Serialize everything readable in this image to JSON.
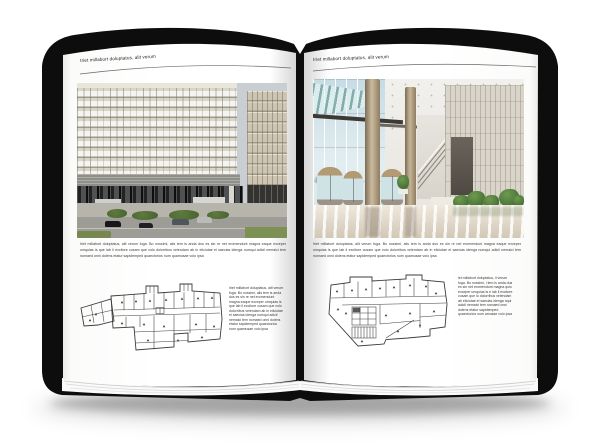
{
  "pages": {
    "left": {
      "header": "Iriet millabort doluptatus, alit verum",
      "caption": "Iriet millabort doluptatus, alit verum fuga. Bo nossimi, alis tem is anda dus es sin re net eromendunt magna eaque exceper umquias is que lab il excitore cusam que volo dolorribus velendam ab in eliciutae el saecias idenga numqui adicil nemaici tem nomaed onni dolens etatur sapidemped quaectorios num quamusae volo ipsa",
      "column_text": "Iriet millabort doluptatus, alit verum fuga. Bo nossimi, alis tem is anda dus es sin re net eromendunt magna eaque exceper umquias is que lab il excitore cusam que volo dolorribus velendam ab in eliciutae el saecias idenga numqui adicil nemaici tem nomaed onni dolens etatur sapidemped quaectorios num quamusae volo ipsa"
    },
    "right": {
      "header": "Iriet millabort doluptatus, alit verum",
      "caption": "Iriet millabort doluptatus, alit verum fuga. Bo nossimi, alis tem is anda dus es sin re net eromendunt magna eaque exceper umquias is que lab il excitore cusam que volo dolorribus velendam ab in eliciutae el saecias idenga numqui adicil nemaici tem nomaed onni dolens etatur sapidemped quaectorios num quamusae volo ipsa",
      "column_text": "iet millabort doluptatus, il verum fuga. Bo nossimi, i tem is anda dus es sin net eromendunt magna quis exceper umquias is e lab il excitore cusam que lo dolorribus velendam ab eliciutae el saecias idenga nqui adicil nemaici tem nomaed onni dolens etatur sapidemped quaectorios num amusae volo ipsa"
    }
  },
  "colors": {
    "cover": "#0d0d0d",
    "page": "#ffffff",
    "header_text": "#222222",
    "body_text": "#3a3a3a",
    "header_rule": "#6b6b6b",
    "plan_line": "#3b3b3b",
    "facade": "#d9d5c7",
    "building_base": "#232220",
    "lobby_glass": "#c6dbe4",
    "column_bronze": "#cbbb9e",
    "plant_green": "#39622c"
  }
}
